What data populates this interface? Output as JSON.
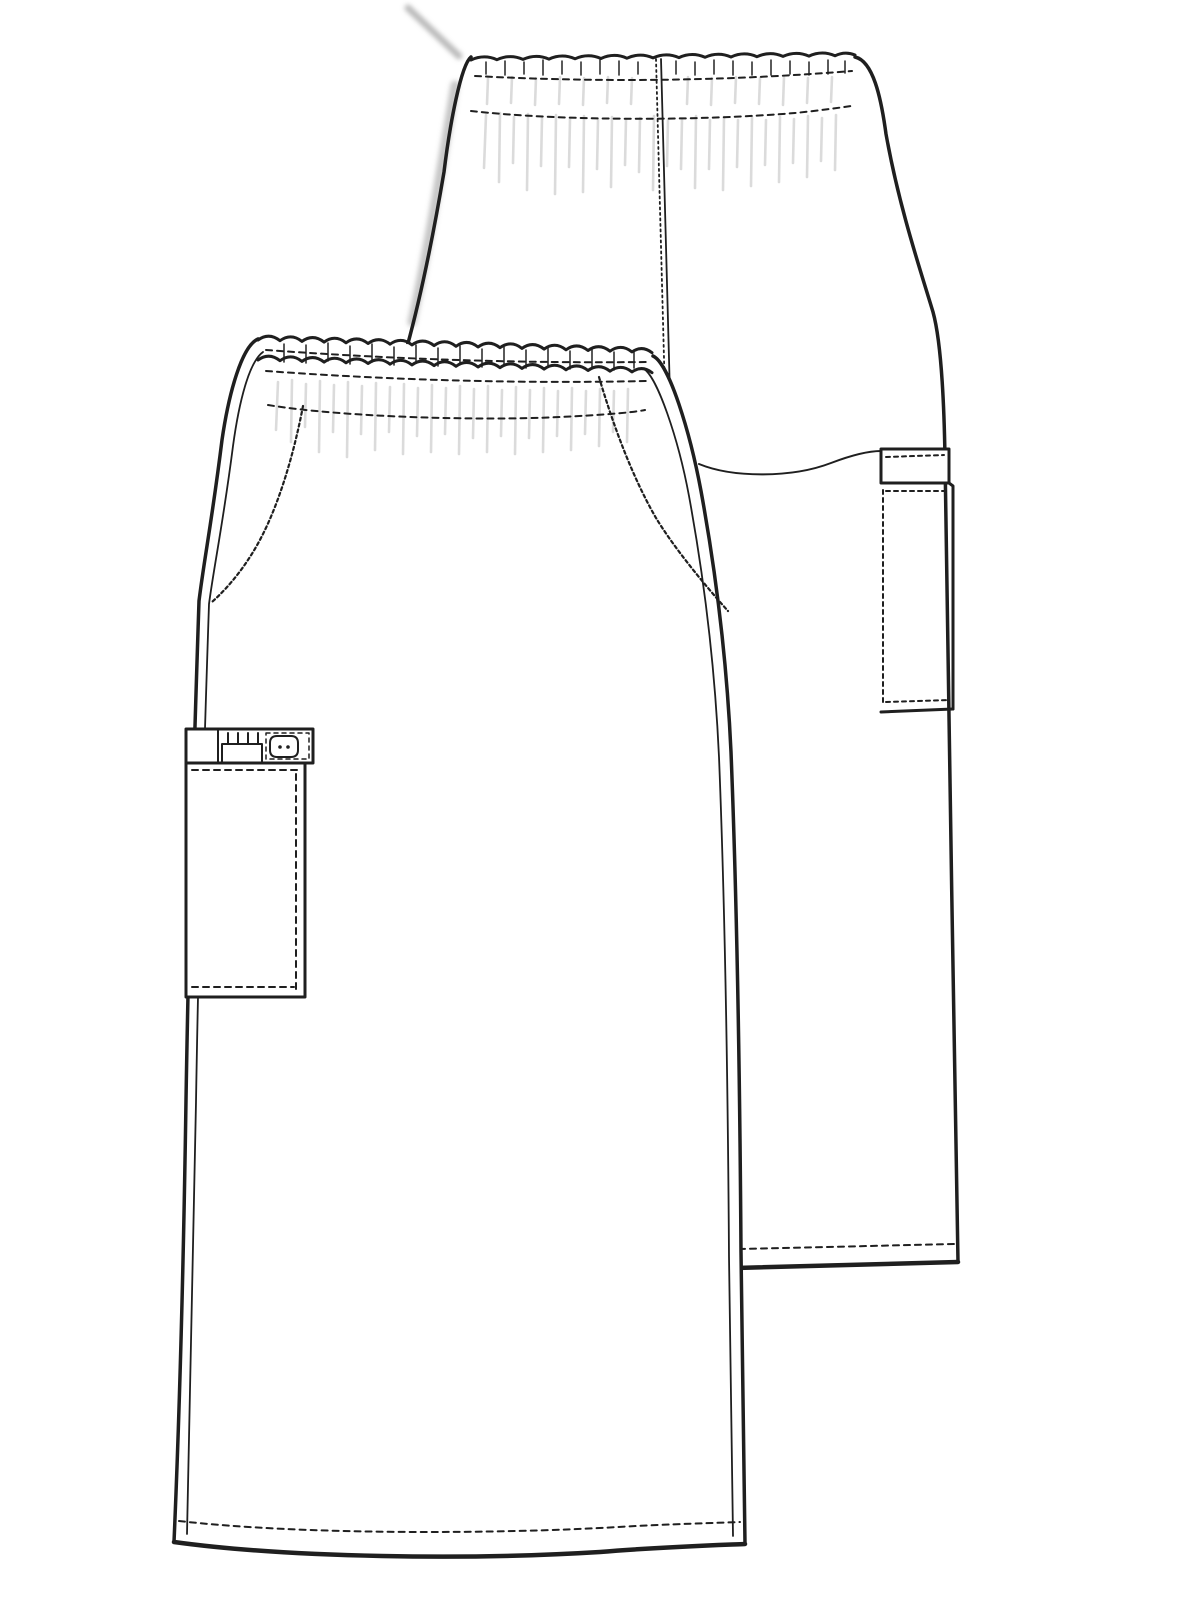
{
  "meta": {
    "description": "Technical flat sketch line drawing of a scrub skirt shown in two overlapping views",
    "garment": "elastic-waist cargo skirt",
    "views": [
      "front",
      "back"
    ]
  },
  "canvas": {
    "width": 1200,
    "height": 1600,
    "background": "#ffffff",
    "line_color": "#1f1f1f",
    "shade_color": "#bdbdbd",
    "smudge_color": "#8f8f8f"
  },
  "views": {
    "back": {
      "outline_right": "M855,57 C873,61 881,97 886,134 C899,207 921,272 933,312 C941,341 944,397 945,458 C948,700 954,1010 958,1262",
      "outline_left": "M471,57 C461,65 450,123 444,172 C432,243 419,303 407,347",
      "waist_top": "M471,60 q13,-6 26,-0.3 q13,-6 26,-0.3 q13,-6 26,-0.3 q13,-6 26,-0.3 q13,-6 26,-0.3 q13,-6 26,-0.3 q13,-6 26,-0.3 q13,-6 26,-0.3 q13,-6 26,-0.3 q13,-6 26,-0.3 q13,-6 26,-0.3 q13,-6 26,-0.3 q13,-6 26,-0.3 q13,-6 26,-0.3 q10,-5 20,-0.8",
      "waistband_stitch_top": "M475,76 Q665,86 852,71",
      "waistband_stitch_bottom": "M471,111 C560,121 700,121 795,113 C815,111 838,108 851,106",
      "center_back_seam": "M661,59 L670,396",
      "center_back_dotted": "M656,59 L665,396",
      "seat_curve": "M699,464 C733,478 792,478 831,463 C852,455 869,451 881,451",
      "hem": "M736,1268 L958,1262",
      "hem_stitch": "M739,1249 L955,1244",
      "ticks": "M486,62 L486,74 M505,61 L505,75 M524,62 L524,74 M543,60 L543,75 M562,61 L562,74 M581,62 L581,75 M600,60 L600,74 M619,61 L619,75 M638,62 L638,74 M676,61 L676,74 M695,62 L695,75 M714,60 L714,74 M733,61 L733,75 M752,62 L752,75 M771,60 L771,75 M790,61 L790,74 M809,62 L809,75 M828,60 L828,74 M845,61 L845,73",
      "gathers": "M488,78 L487,104 M512,77 L511,103 M536,78 L535,105 M560,77 L559,104 M584,78 L583,105 M608,77 L607,103 M632,78 L631,104 M688,77 L687,104 M712,78 L711,105 M736,77 L735,103 M760,78 L759,104 M784,77 L783,105 M808,78 L807,103 M832,77 L831,102 M486,115 L484,168 M500,113 L499,182 M514,117 L513,163 M528,114 L527,190 M542,118 L541,166 M556,115 L555,194 M570,119 L569,167 M584,116 L583,192 M598,120 L597,169 M612,117 L611,187 M626,119 L625,165 M640,118 L639,172 M654,116 L653,190 M668,120 L667,166 M682,119 L681,169 M696,116 L695,188 M710,120 L709,169 M724,117 L723,190 M738,120 L737,167 M752,117 L751,186 M766,120 L765,165 M780,117 L779,182 M794,119 L793,163 M808,116 L807,177 M822,118 L821,161 M836,115 L835,170",
      "smudge_top": "M408,8 L459,56",
      "soft_left_shadow": "M455,85 C444,150 428,250 412,322",
      "side_pocket": {
        "band": "M881,449 L949,449 L949,483 L881,483 Z",
        "band_stitch": "M886,457 L944,455",
        "body_right": "M949,483 L953,486 L953,709",
        "body_bottom": "M881,712 L953,709",
        "body_left_stitch": "M883,490 L883,705",
        "body_top_stitch": "M886,491 L946,491",
        "body_bottom_stitch": "M886,702 L948,700"
      }
    },
    "front": {
      "silhouette": "M258,339 C242,346 229,392 222,440 C212,521 204,560 199,601 C193,780 189,920 186,1100 C183,1300 178,1450 174,1542 C290,1558 470,1560 600,1552 C660,1547 722,1545 745,1544 C744,1482 742,1382 741,1252 C740,1102 737,902 731,752 C726,642 712,551 701,491 C690,432 669,363 653,356 C555,349 360,342 258,339 Z",
      "outline_left": "M258,339 C242,346 229,392 222,440 C212,521 204,560 199,601 C193,780 189,920 186,1100 C183,1300 178,1450 174,1542",
      "inner_left": "M263,352 C249,362 239,402 233,446 C223,524 214,566 209,604 C203,782 199,922 196,1102 C193,1300 190,1452 187,1534",
      "outline_right": "M653,356 C669,363 690,432 701,491 C712,551 726,642 731,752 C737,902 740,1102 741,1252 C742,1382 744,1482 745,1544",
      "inner_right": "M644,369 C657,377 678,437 689,496 C700,556 714,647 719,757 C725,907 728,1107 729,1257 C730,1387 732,1487 733,1536",
      "waist_scallop_1": "M258,340 q11,-8 22,0.7 q11,-8 22,0.7 q11,-8 22,0.7 q11,-8 22,0.7 q11,-8 22,0.7 q11,-8 22,0.7 q11,-8 22,0.7 q11,-8 22,0.7 q11,-8 22,0.7 q11,-8 22,0.7 q11,-8 22,0.7 q11,-8 22,0.7 q11,-8 22,0.7 q11,-8 22,0.7 q11,-8 22,0.7 q11,-8 22,0.7 q11,-8 22,0.7 q10,-7 20,0.8",
      "waist_scallop_2": "M258,360 q11,-8 22,0.7 q11,-8 22,0.7 q11,-8 22,0.7 q11,-8 22,0.7 q11,-8 22,0.7 q11,-8 22,0.7 q11,-8 22,0.7 q11,-8 22,0.7 q11,-8 22,0.7 q11,-8 22,0.7 q11,-8 22,0.7 q11,-8 22,0.7 q11,-8 22,0.7 q11,-8 22,0.7 q11,-8 22,0.7 q11,-8 22,0.7 q11,-8 22,0.7 q10,-7 20,0.8",
      "waistband_stitch_mid": "M266,350 Q460,364 646,362",
      "waistband_stitch_low": "M266,371 Q460,385 646,381",
      "gather_stitch_row": "M268,405 C340,417 480,421 560,417 C600,415 630,413 645,410",
      "slant_pocket_left_stitch": "M303,406 C297,438 284,492 263,534 C249,562 231,585 212,602",
      "slant_pocket_right_stitch": "M599,377 C614,428 633,478 656,518 C673,546 702,582 728,611",
      "hem": "M174,1542 C290,1558 470,1560 600,1552 C660,1547 722,1545 745,1544",
      "hem_stitch": "M179,1521 C300,1535 500,1534 618,1527 C670,1524 716,1523 740,1522",
      "ticks": "M284,344 L284,362 M306,345 L306,363 M328,343 L328,361 M350,346 L350,364 M372,344 L372,362 M394,347 L394,365 M416,345 L416,363 M438,348 L438,366 M460,346 L460,364 M482,349 L482,367 M504,347 L504,365 M526,350 L526,368 M548,348 L548,366 M570,351 L570,369 M592,349 L592,367 M614,352 L614,370 M634,350 L634,368",
      "gathers": "M278,382 L276,430 M292,380 L291,442 M306,384 L305,427 M320,381 L319,452 M334,385 L333,432 M348,382 L347,457 M362,386 L361,434 M376,383 L375,450 M390,387 L389,432 M404,384 L403,454 M418,388 L417,436 M432,385 L431,452 M446,388 L445,434 M460,386 L459,454 M474,389 L473,438 M488,386 L487,452 M502,390 L501,436 M516,387 L515,454 M530,390 L529,438 M544,388 L543,452 M558,391 L557,436 M572,388 L571,450 M586,391 L585,434 M600,389 L599,446 M614,391 L613,432 M628,389 L627,442",
      "cargo_pocket": {
        "band": "M186,729 L313,729 L313,763 L186,763 Z",
        "band_divider": "M218,729 L218,763",
        "pen_slot": "M222,744 L262,744 L262,763 L222,763 Z",
        "pen_stitches": "M228,733 L228,743 M238,733 L238,743 M248,733 L248,743 M258,733 L258,743",
        "button_section_stitch": "M266,733 L309,733 L309,759 L266,759 Z",
        "button": "M277,736 L291,736 Q298,736 298,743 L298,750 Q298,757 291,757 L277,757 Q270,757 270,750 L270,743 Q270,736 277,736 Z",
        "button_holes": "M280,747 l0.01,0 M288,747 l0.01,0",
        "body": "M186,763 L305,763 L305,997 L186,997 Z",
        "body_top_stitch": "M192,770 L300,770",
        "body_right_stitch": "M296,774 L296,989",
        "body_bottom_stitch": "M192,987 L294,987"
      }
    }
  }
}
